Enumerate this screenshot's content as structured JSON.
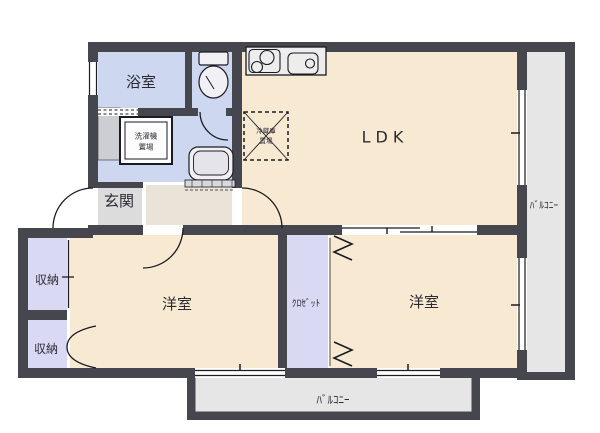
{
  "rooms": {
    "bath": "浴室",
    "ldk": "LDK",
    "entrance": "玄関",
    "storage_top": "収納",
    "storage_bottom": "収納",
    "bedroom_left": "洋室",
    "bedroom_right": "洋室",
    "closet": "ｸﾛｾﾞｯﾄ",
    "balcony_right": "ﾊﾞﾙｺﾆｰ",
    "balcony_bottom": "ﾊﾞﾙｺﾆｰ"
  },
  "fixtures": {
    "washer_line1": "洗濯機",
    "washer_line2": "置場",
    "fridge_line1": "冷蔵庫",
    "fridge_line2": "置場"
  },
  "icons": [
    "toilet-icon",
    "washbasin-icon",
    "stove-icon",
    "sink-icon",
    "washing-machine-area-icon",
    "refrigerator-area-icon",
    "door-swing-icon",
    "folding-door-icon",
    "sliding-door-icon",
    "window-icon"
  ],
  "colors": {
    "wall": "#46464e",
    "room_cream": "#f8e9d2",
    "room_wet": "#cdd7f0",
    "room_storage": "#d9d9f4",
    "entrance_floor": "#dcdcdc",
    "hall_floor": "#eae4d8",
    "balcony": "#e6e6e6",
    "line": "#1b1b22"
  }
}
